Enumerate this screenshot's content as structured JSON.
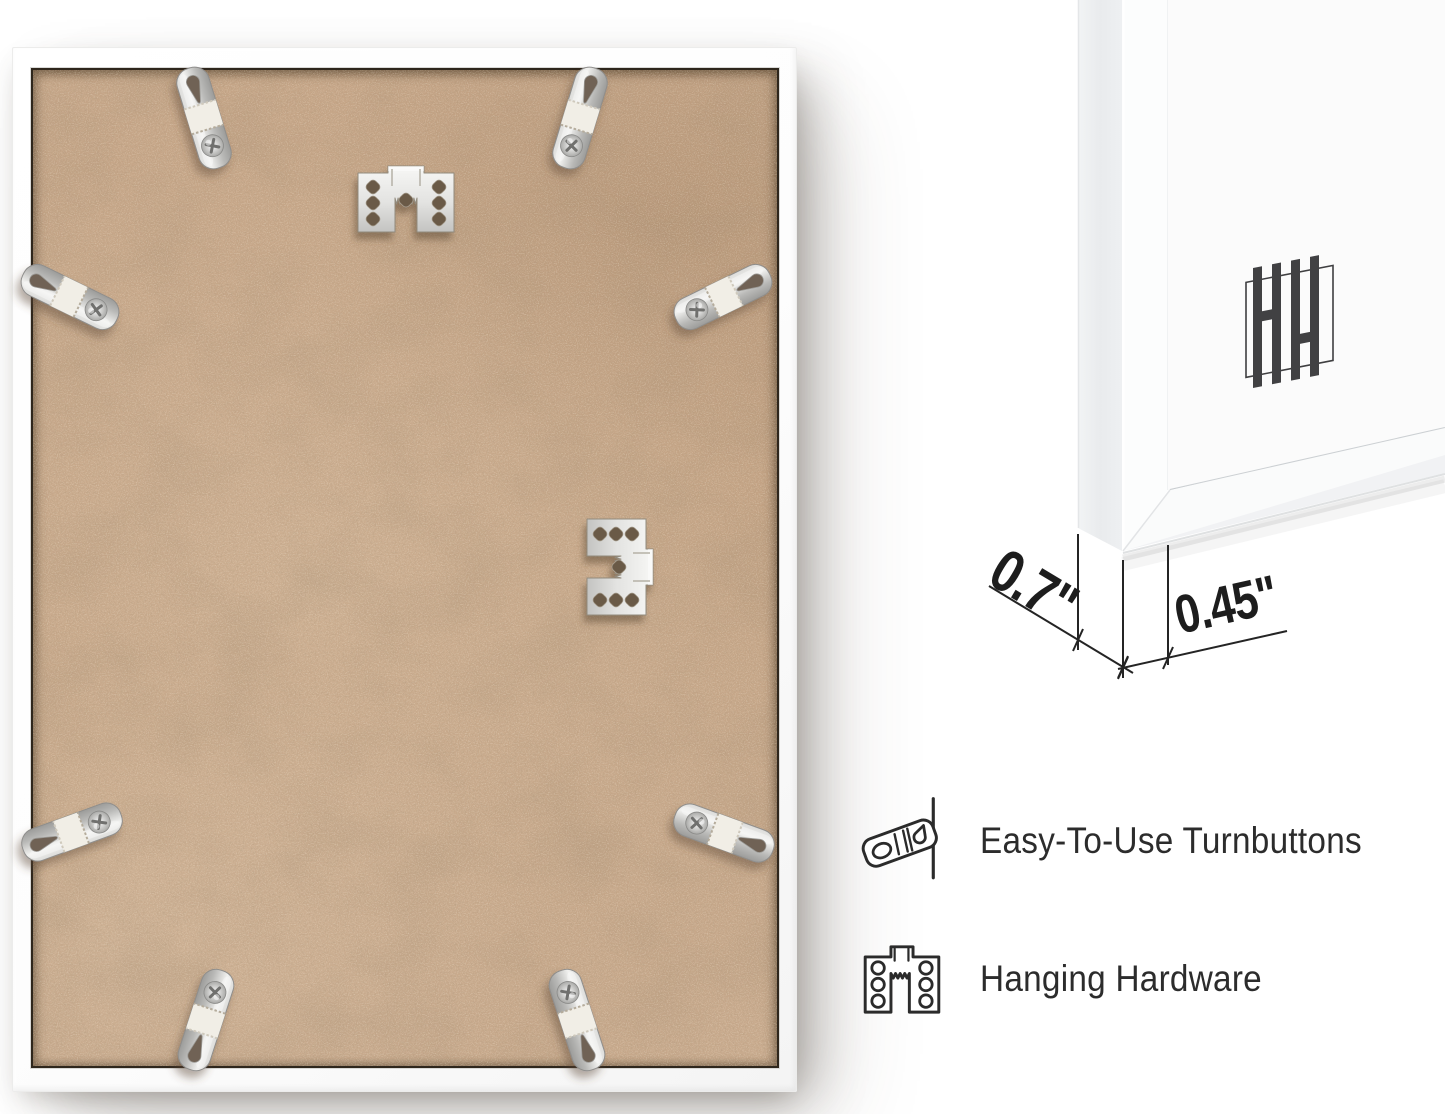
{
  "page": {
    "background_color": "#ffffff"
  },
  "back_photo": {
    "description": "back of picture frame with kraft backing",
    "frame_color": "#ffffff",
    "backing_color": "#c4a486",
    "backing_border_color": "#2e261c",
    "hardware_metal_color": "#d6d6d4",
    "turnbutton_count": 8,
    "sawtooth_hanger_count": 2
  },
  "corner_view": {
    "description": "frame corner close-up with depth and face dimensions",
    "frame_color": "#ffffff",
    "side_face_color": "#edeff1",
    "logo_icon": "hh-logo",
    "logo_color": "#414143",
    "dimension_text_color": "#1d1d1d",
    "depth_dimension": "0.7\"",
    "face_dimension": "0.45\""
  },
  "features": [
    {
      "icon": "turnbutton-icon",
      "label": "Easy-To-Use Turnbuttons"
    },
    {
      "icon": "sawtooth-hanger-icon",
      "label": "Hanging Hardware"
    }
  ],
  "feature_text_color": "#2c2c2c"
}
